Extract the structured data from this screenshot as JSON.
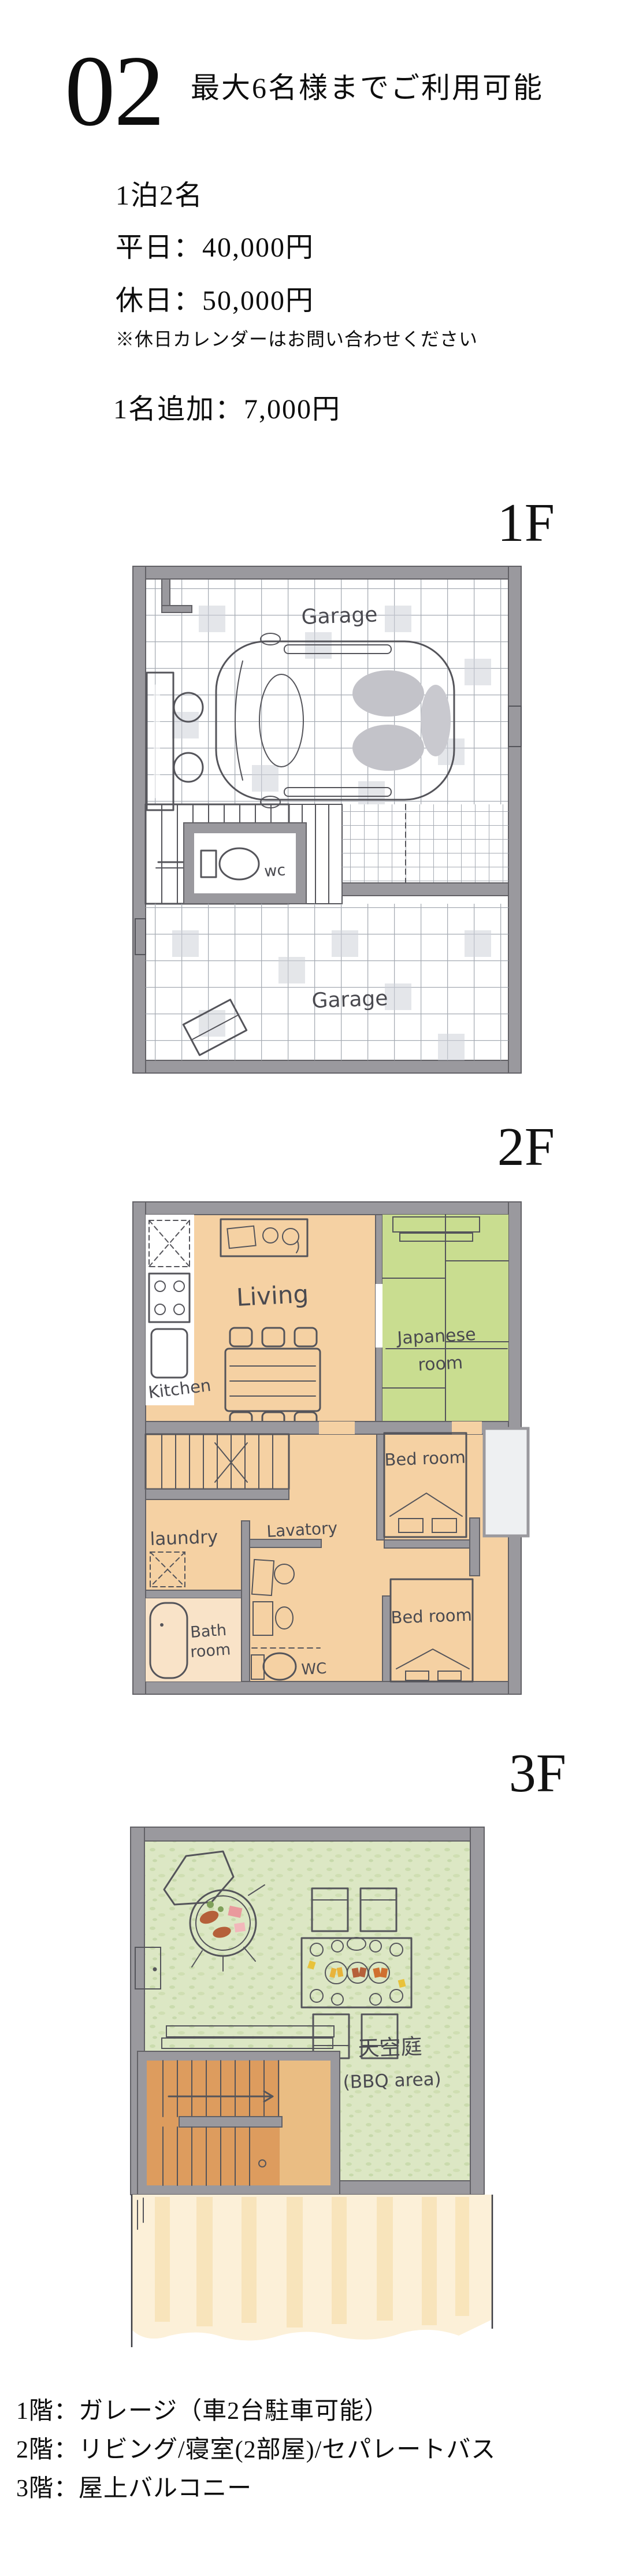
{
  "header": {
    "index_number": "02",
    "capacity_note": "最大6名様までご利用可能"
  },
  "pricing": {
    "base_label": "1泊2名",
    "weekday": "平日：40,000円",
    "holiday": "休日：50,000円",
    "holiday_note": "※休日カレンダーはお問い合わせください",
    "extra_person": "1名追加：7,000円"
  },
  "floors": [
    {
      "label": "1F",
      "rooms": {
        "garage_upper": "Garage",
        "wc": "wc",
        "garage_lower": "Garage"
      }
    },
    {
      "label": "2F",
      "rooms": {
        "living": "Living",
        "kitchen": "Kitchen",
        "japanese_line1": "Japanese",
        "japanese_line2": "room",
        "bedroom_upper": "Bed room",
        "laundry": "laundry",
        "lavatory": "Lavatory",
        "bath_line1": "Bath",
        "bath_line2": "room",
        "wc": "WC",
        "bedroom_lower": "Bed room"
      }
    },
    {
      "label": "3F",
      "rooms": {
        "sky_garden": "天空庭",
        "bbq_area": "(BBQ area)"
      }
    }
  ],
  "legend": {
    "floor1": "1階：ガレージ（車2台駐車可能）",
    "floor2": "2階：リビング/寝室(2部屋)/セパレートバス",
    "floor3": "3階：屋上バルコニー"
  },
  "colors": {
    "wall_gray": "#9a999e",
    "wood_orange": "#dd9c5e",
    "floor_orange": "#f5d1a3",
    "tatami_green": "#c9dd90",
    "lawn_green": "#dce7c4",
    "water_blue": "#a9c8e1",
    "roof_cream": "#fcf0d8",
    "ink": "#54545a",
    "text_black": "#0d0d0d"
  }
}
